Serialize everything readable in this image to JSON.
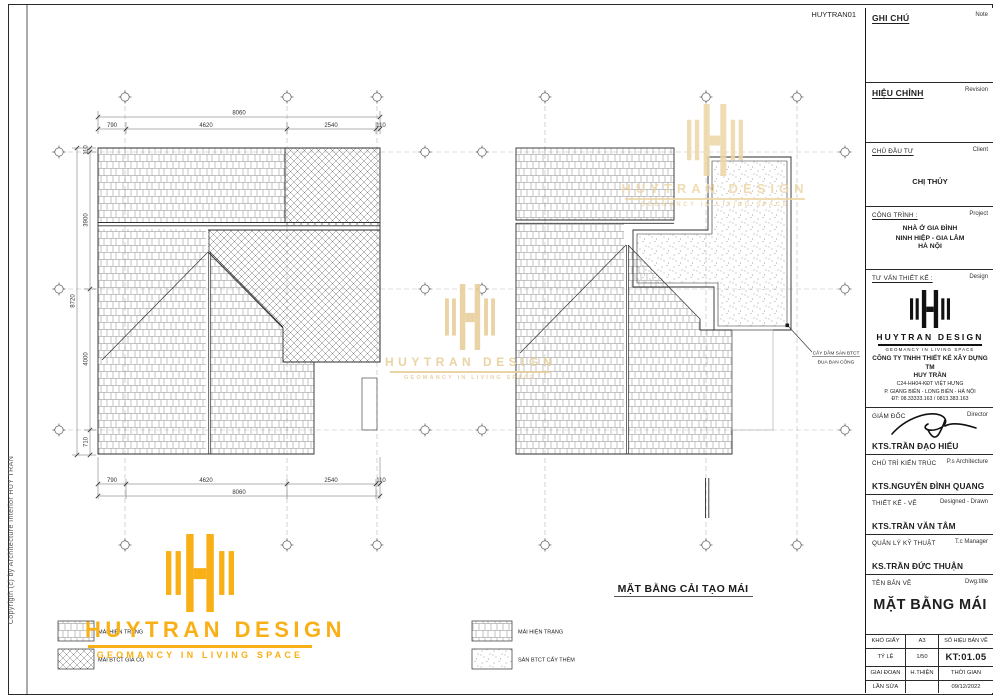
{
  "page": {
    "sheet_code": "HUYTRAN01",
    "copyright": "Copyrigth (c) by  Architecture Interior HUY TRAN"
  },
  "brand": {
    "name": "HUYTRAN DESIGN",
    "tagline": "GEOMANCY IN LIVING SPACE",
    "orange": "#F9B017",
    "watermark_gold": "#E8CF9B"
  },
  "drawing_left": {
    "dim_total_h": "8060",
    "dim_h_segments": [
      "790",
      "4620",
      "2540",
      "110"
    ],
    "dim_total_v": "8720",
    "dim_v_segments": [
      "110",
      "3900",
      "4000",
      "710"
    ]
  },
  "drawing_right": {
    "title": "MẶT BẰNG CẢI TẠO MÁI",
    "annotation": {
      "line1": "CẤY DẦM SÀN BTCT",
      "line2": "ĐUA BAN CÔNG"
    }
  },
  "legend_left": {
    "item1": "MÁI HIỆN TRẠNG",
    "item2": "MÁI BTCT GIẢ CỔ"
  },
  "legend_right": {
    "item1": "MÁI HIỆN TRẠNG",
    "item2": "SÀN BTCT CẤY THÊM"
  },
  "titleblock": {
    "note": {
      "vi": "GHI CHÚ",
      "en": "Note"
    },
    "revision": {
      "vi": "HIỆU CHỈNH",
      "en": "Revision"
    },
    "client": {
      "vi": "CHỦ ĐẦU TƯ",
      "en": "Client",
      "value": "CHỊ THỦY"
    },
    "project": {
      "vi": "CÔNG TRÌNH :",
      "en": "Project",
      "line1": "NHÀ Ở GIA ĐÌNH",
      "line2": "NINH HIỆP - GIA LÂM",
      "line3": "HÀ NỘI"
    },
    "consultant": {
      "vi": "TƯ VẤN THIẾT KẾ :",
      "en": "Design",
      "company1": "CÔNG TY TNHH THIẾT KẾ XÂY DỰNG TM",
      "company2": "HUY TRẦN",
      "addr1": "C24-HH04-KĐT VIỆT HƯNG",
      "addr2": "P. GIANG BIÊN - LONG BIÊN - HÀ NỘI",
      "addr3": "ĐT: 08.33333.163 / 0813.383.163"
    },
    "director": {
      "vi": "GIÁM ĐỐC",
      "en": "Director",
      "name": "KTS.TRẦN ĐẠO HIẾU"
    },
    "architect": {
      "vi": "CHỦ TRÌ KIẾN TRÚC",
      "en": "P.s Architecture",
      "name": "KTS.NGUYỄN ĐÌNH QUANG"
    },
    "designer": {
      "vi": "THIẾT KẾ - VẼ",
      "en": "Designed - Drawn",
      "name": "KTS.TRẦN VĂN TÂM"
    },
    "tech_manager": {
      "vi": "QUẢN LÝ KỸ THUẬT",
      "en": "T.c Manager",
      "name": "KS.TRẦN ĐỨC THUẬN"
    },
    "drawing_title": {
      "vi": "TÊN BẢN VẼ",
      "en": "Dwg.title",
      "value": "MẶT BẰNG MÁI"
    },
    "info": {
      "paper_label": "KHỔ GIẤY",
      "paper_value": "A3",
      "number_label": "SỐ HIỆU BẢN VẼ",
      "number_value": "KT:01.05",
      "scale_label": "TỶ LỆ",
      "scale_value": "1/50",
      "stage_label": "GIAI ĐOẠN",
      "stage_value": "H.THIỆN",
      "time_label": "THỜI GIAN",
      "time_value": "09/12/2022",
      "rev_label": "LẦN SỬA"
    }
  }
}
